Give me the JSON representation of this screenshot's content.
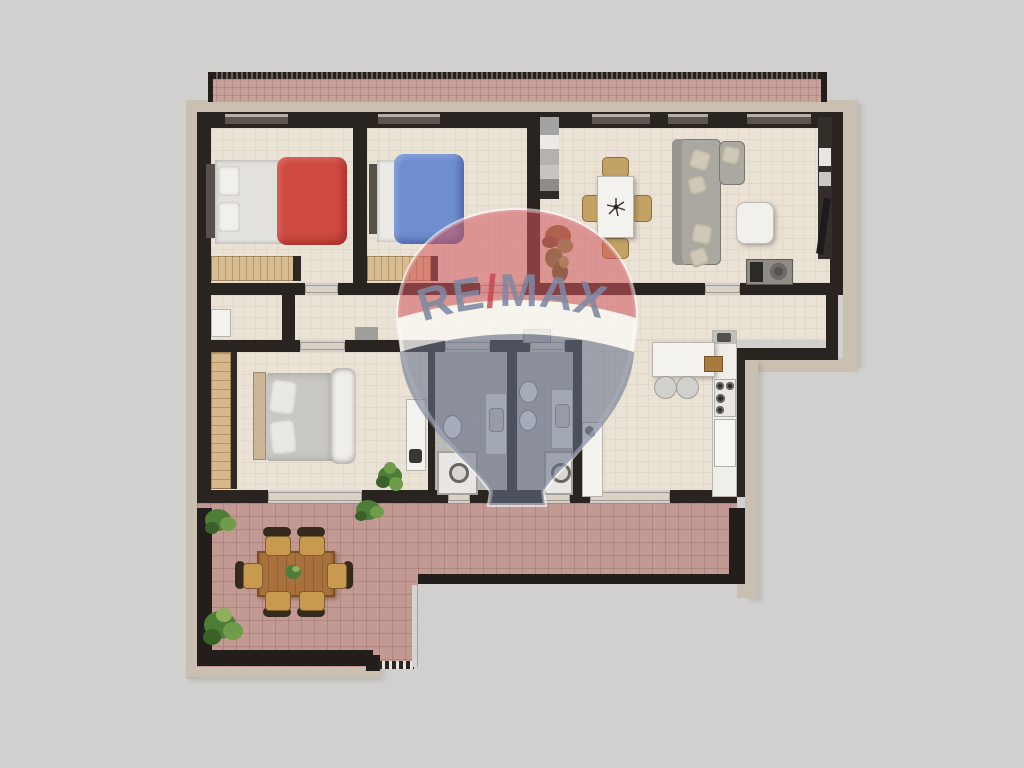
{
  "watermark": {
    "brand_re": "RE",
    "brand_slash": "/",
    "brand_max": "MAX"
  },
  "palette": {
    "background": "#d2d0ce",
    "outer_wall": "#c9c0b2",
    "inner_wall": "#2a2420",
    "room_floor": "#eae2d5",
    "bathroom_floor": "#bdbbb6",
    "terrace_tile": "#c39a93",
    "bed_red": "#ce4a42",
    "bed_blue": "#6e8ecf",
    "sofa_gray": "#aba8a1",
    "furniture_wood": "#d9bd92",
    "table_wood": "#a8703c",
    "balloon_red": "rgba(209,86,92,0.55)",
    "balloon_blue": "rgba(104,114,137,0.58)",
    "remax_letters": "#7e88a2",
    "remax_slash": "#c3444e"
  },
  "diagram": {
    "type": "floor-plan",
    "rooms": [
      {
        "name": "bedroom-1",
        "furniture": [
          "double-bed-red",
          "dresser"
        ]
      },
      {
        "name": "bedroom-2",
        "furniture": [
          "double-bed-blue",
          "dresser"
        ]
      },
      {
        "name": "entry",
        "furniture": [
          "wardrobe",
          "plant"
        ]
      },
      {
        "name": "living-dining",
        "furniture": [
          "dining-table",
          "4-chairs",
          "sectional-sofa",
          "ottoman",
          "tv-cabinet",
          "media-wall"
        ]
      },
      {
        "name": "corridor",
        "furniture": [
          "shoe-cabinet",
          "mat"
        ]
      },
      {
        "name": "master-bedroom",
        "furniture": [
          "wardrobe",
          "double-bed",
          "desk",
          "plant"
        ]
      },
      {
        "name": "bathroom-1",
        "furniture": [
          "toilet",
          "vanity-sink",
          "shower"
        ]
      },
      {
        "name": "bathroom-2",
        "furniture": [
          "toilet",
          "bidet",
          "vanity-sink",
          "shower"
        ]
      },
      {
        "name": "kitchen",
        "furniture": [
          "tall-unit",
          "island",
          "2-stools",
          "cooktop",
          "oven",
          "sink"
        ]
      },
      {
        "name": "terrace-top",
        "furniture": []
      },
      {
        "name": "terrace-main",
        "furniture": [
          "outdoor-table",
          "6-chairs",
          "plants"
        ]
      }
    ]
  }
}
